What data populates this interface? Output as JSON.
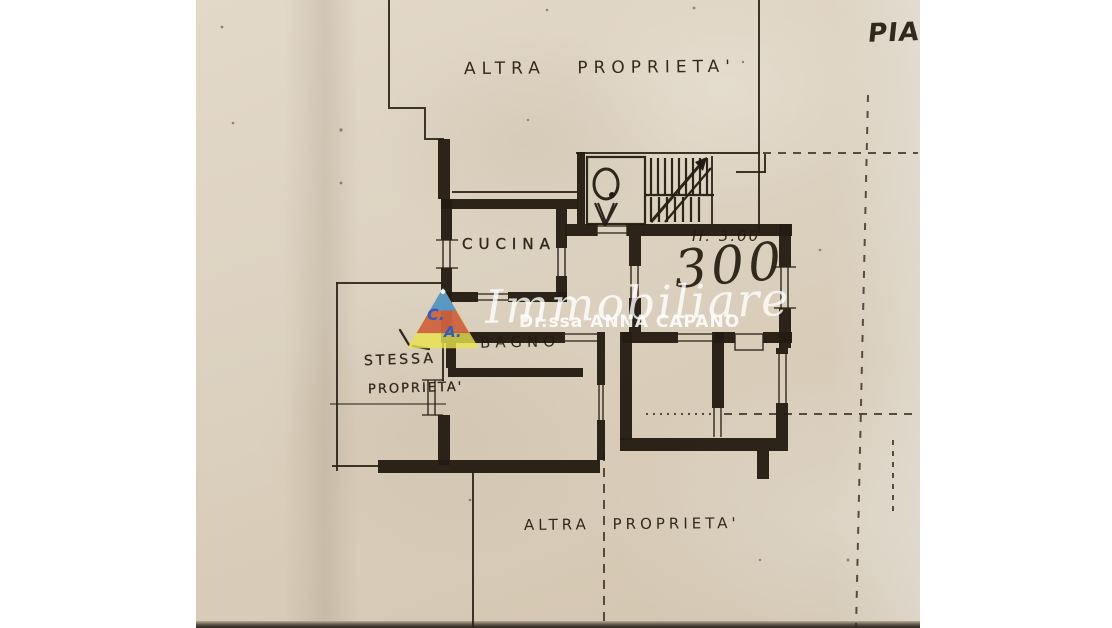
{
  "photo": {
    "paper_color": "#dcd1bf",
    "ink_color": "#241c12",
    "labels": {
      "altra_top": "ALTRA PROPRIETA'",
      "piano": "PIA",
      "cucina": "CUCINA",
      "height": "H. 3.00",
      "area": "300",
      "bagno": "BAGNO",
      "stessa1": "STESSA",
      "stessa2": "PROPRIETA'",
      "altra_bottom": "ALTRA PROPRIETA'"
    },
    "icons": {
      "elevator": "elevator-icon",
      "stairs": "stairs-icon"
    }
  },
  "watermark": {
    "title": "Immobiliare",
    "subtitle": "Dr.ssa ANNA CAPANO",
    "logo": {
      "letter_c": "C.",
      "letter_a": "A."
    },
    "colors": {
      "triangle_yellow": "#e9e44e",
      "triangle_red": "#c7403a",
      "triangle_blue": "#4d9fd3",
      "letters_blue": "#2e5ec2",
      "text_white": "#ffffff"
    }
  }
}
